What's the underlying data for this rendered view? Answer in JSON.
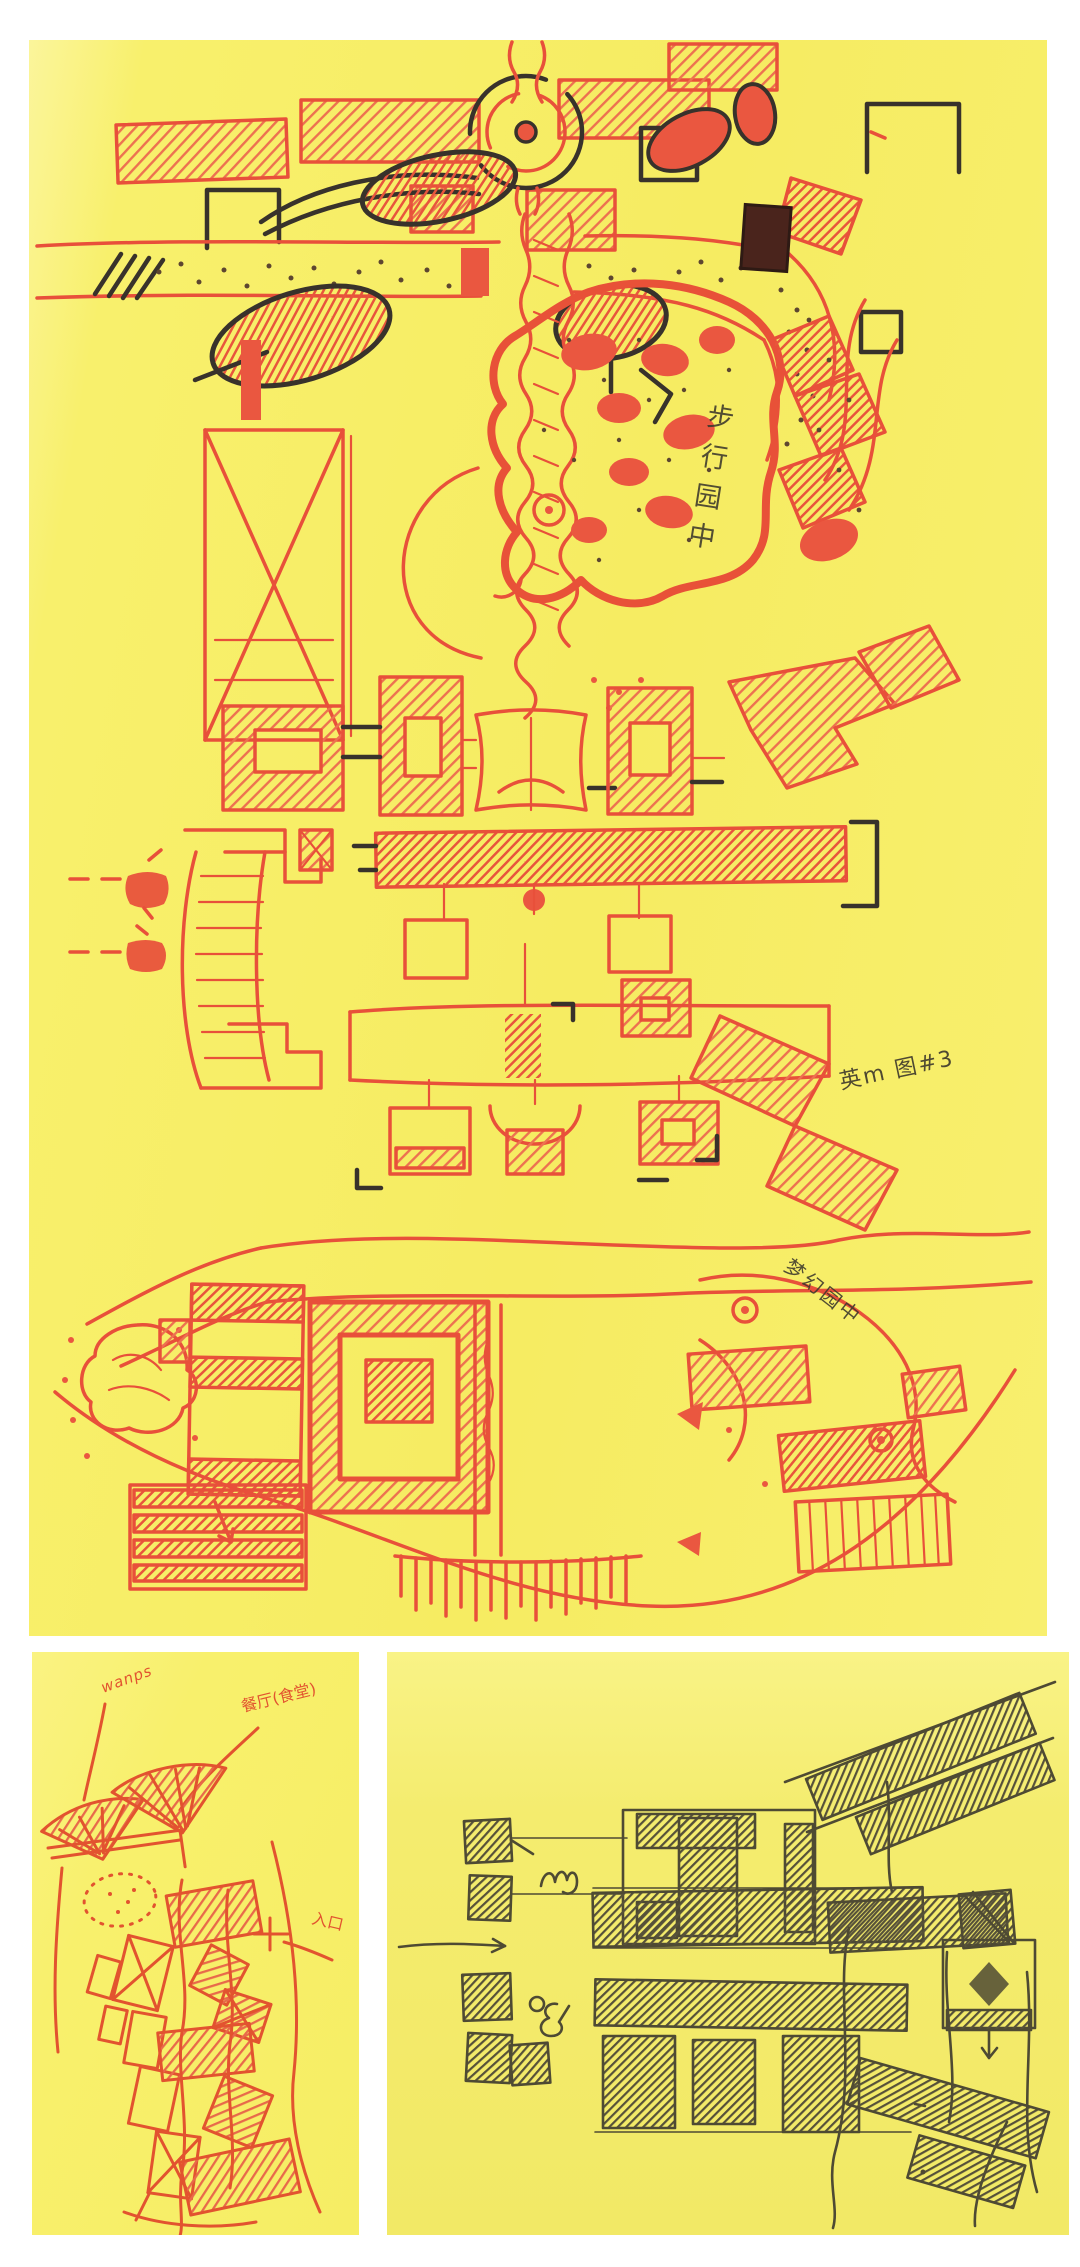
{
  "image": {
    "description": "Scanned hand-drawn architectural site-plan concept sketches on yellow tracing paper",
    "panel_count": 3
  },
  "colors": {
    "page_background": "#ffffff",
    "paper_yellow": "#f7ee66",
    "paper_yellow_light": "#fbf59b",
    "paper_yellow_olive": "#f3ea6a",
    "marker_red": "#e8503a",
    "marker_red_light": "#ee7b5c",
    "ink_black": "#38322b",
    "pencil_olive": "#4e4a33",
    "pen_red": "#e2532f",
    "stipple_brown": "#5d4630"
  },
  "site_plan": {
    "annotations": {
      "garden_note_vertical": "步行园中",
      "figure_note": "英m 图#3",
      "garden_note_diagonal": "梦幻园中"
    }
  },
  "canopy_sketch": {
    "annotations": {
      "canopy_label": "wanps",
      "restaurant_label": "餐厅(食堂)",
      "entrance_label": "入口"
    }
  },
  "pencil_plan": {
    "annotations": {}
  }
}
